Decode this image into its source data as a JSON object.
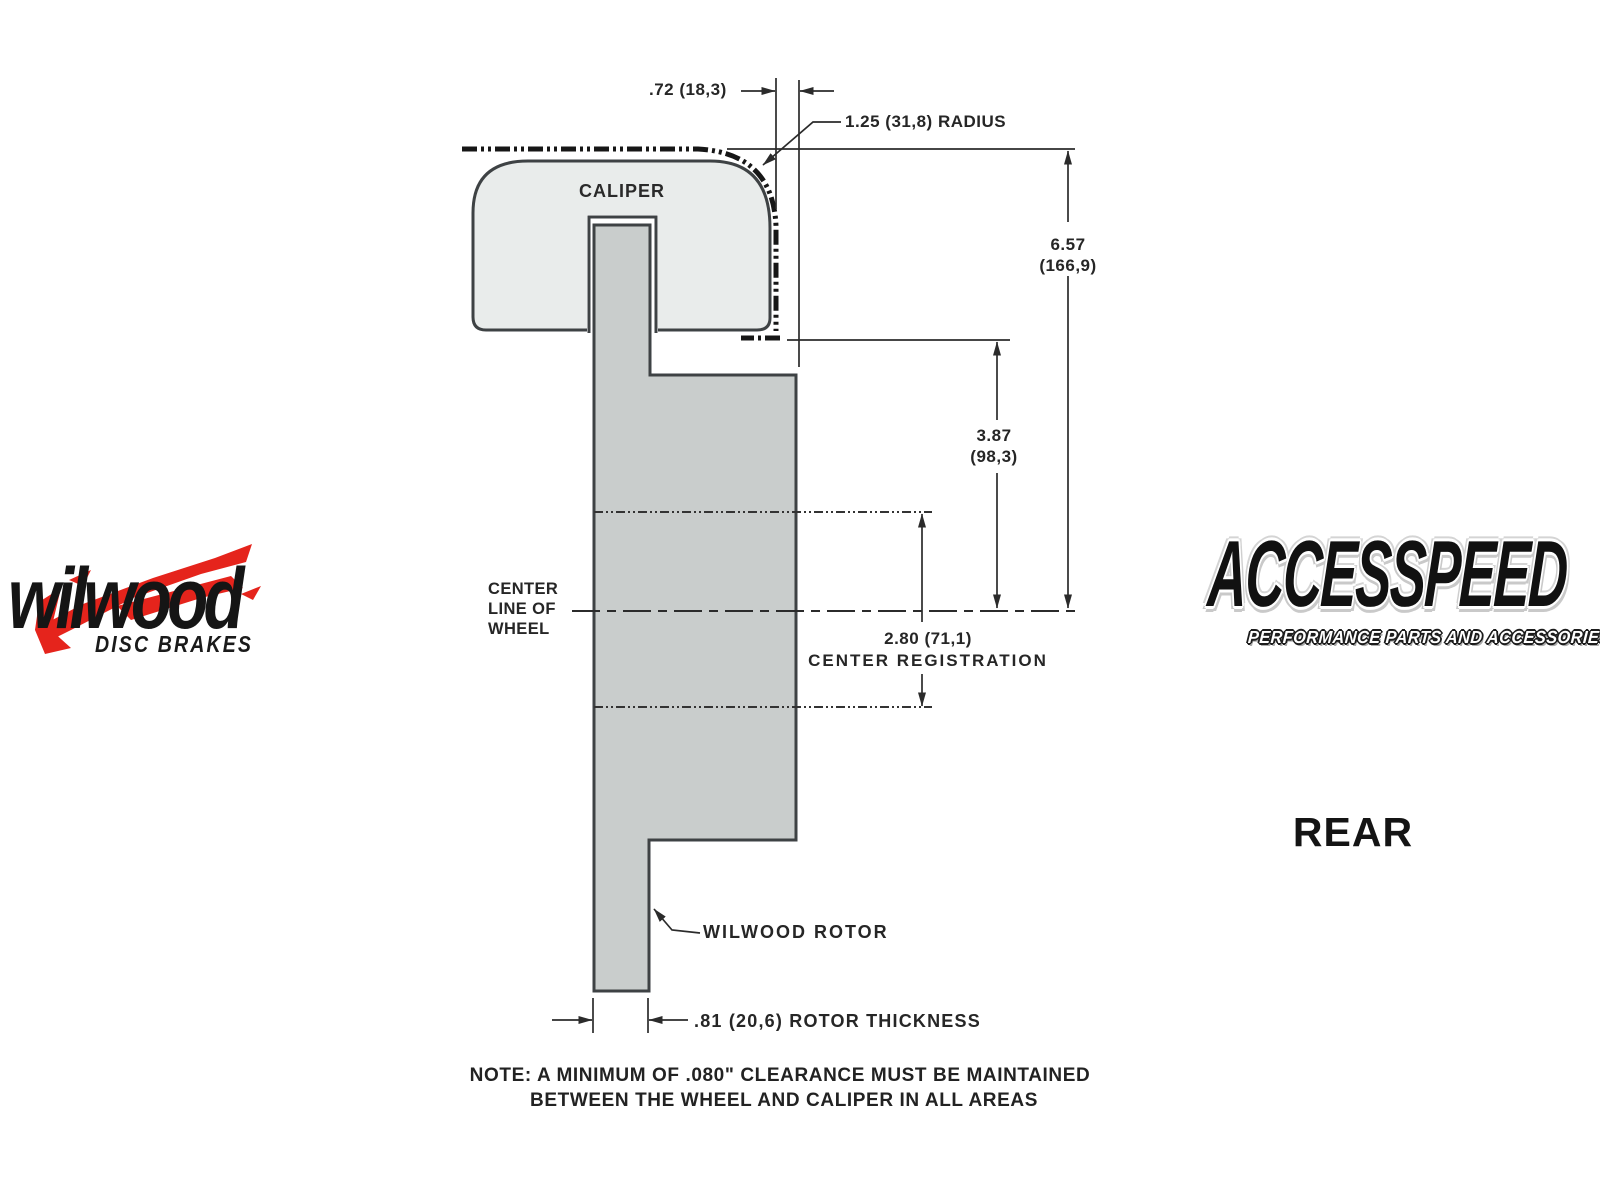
{
  "colors": {
    "background": "#ffffff",
    "caliper_fill": "#e9eceb",
    "rotor_fill": "#c9cdcc",
    "outline": "#3e4244",
    "dimension_lines": "#2b2b2b",
    "wheel_phantom_line": "#161616",
    "wilwood_red": "#e5241c",
    "logo_black": "#151515"
  },
  "drawing": {
    "caliper_label": "CALIPER",
    "top_width_dim": ".72 (18,3)",
    "radius_label": "1.25 (31,8) RADIUS",
    "overall_height_in": "6.57",
    "overall_height_mm": "(166,9)",
    "mount_height_in": "3.87",
    "mount_height_mm": "(98,3)",
    "centerline_line1": "CENTER",
    "centerline_line2": "LINE OF",
    "centerline_line3": "WHEEL",
    "center_reg_dim": "2.80 (71,1)",
    "center_reg_label": "CENTER REGISTRATION",
    "rotor_label": "WILWOOD ROTOR",
    "rotor_thickness_dim": ".81 (20,6) ROTOR THICKNESS",
    "view_label": "REAR"
  },
  "note": {
    "line1": "NOTE: A MINIMUM OF .080\" CLEARANCE MUST BE MAINTAINED",
    "line2": "BETWEEN THE WHEEL AND CALIPER IN ALL AREAS"
  },
  "logos": {
    "wilwood_wordmark": "wilwood",
    "wilwood_tagline": "DISC BRAKES",
    "accesspeed_wordmark": "ACCESSPEED",
    "accesspeed_tagline": "PERFORMANCE PARTS AND ACCESSORIES"
  }
}
